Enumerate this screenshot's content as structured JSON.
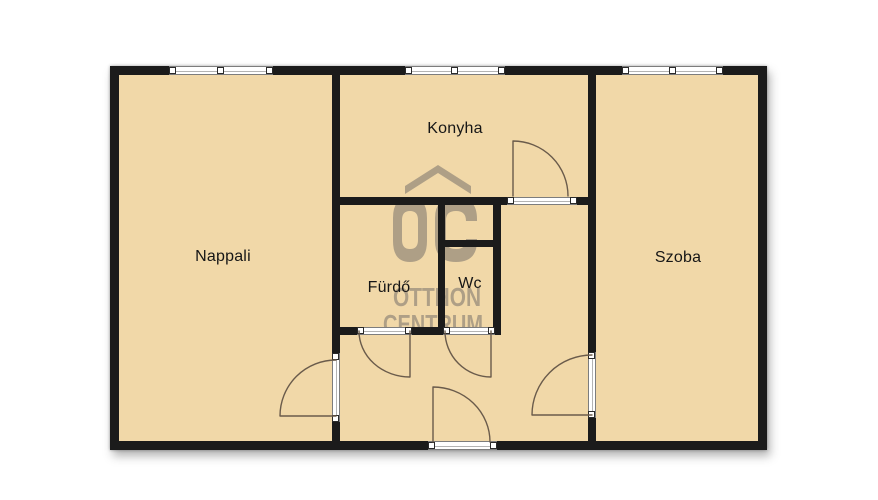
{
  "floorplan": {
    "rooms": [
      {
        "id": "nappali",
        "label": "Nappali"
      },
      {
        "id": "konyha",
        "label": "Konyha"
      },
      {
        "id": "furdo",
        "label": "Fürdő"
      },
      {
        "id": "wc",
        "label": "Wc"
      },
      {
        "id": "szoba",
        "label": "Szoba"
      }
    ],
    "watermark": {
      "logo_text": "OC",
      "name_line1": "OTTHON",
      "name_line2": "CENTRUM"
    },
    "colors": {
      "floor": "#f1d8a8",
      "wall": "#1b1b1b",
      "watermark": "#8f8577",
      "background": "#ffffff"
    }
  }
}
